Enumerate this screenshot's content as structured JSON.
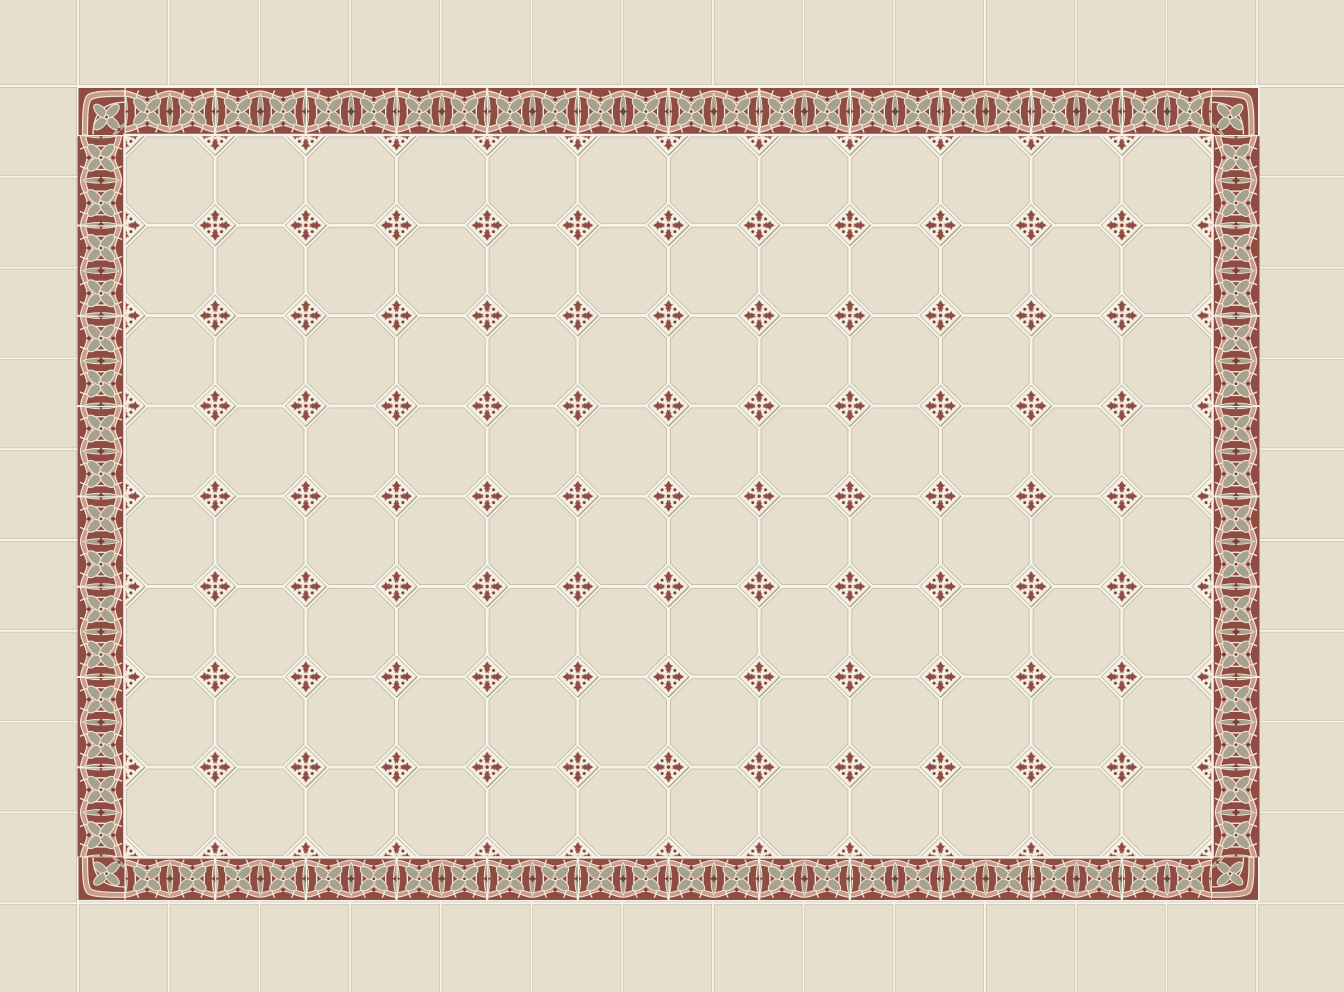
{
  "meta": {
    "label": "octagon-tile-floor-with-ornamental-border"
  },
  "palette": {
    "tile_cream": "#e6dfcd",
    "grout_white": "#f6f3e9",
    "grout_shadow": "#b9b2a0",
    "maroon": "#8e4c43",
    "maroon_deep": "#7c3d34",
    "grey_green": "#a7a190",
    "dusty_pink": "#c79e8d",
    "ribbon_cream": "#f1e5d2",
    "diamond_white": "#f3efe2",
    "diamond_shadow": "#a99f8b"
  },
  "layout": {
    "octagon_columns": 12,
    "octagon_rows": 8,
    "full_diamond_insert_columns": 11,
    "full_diamond_insert_rows": 7,
    "edge_half_diamonds_top": 11,
    "edge_half_diamonds_bottom": 11,
    "edge_half_diamonds_left": 7,
    "edge_half_diamonds_right": 7,
    "border_tiles_top": 12,
    "border_tiles_bottom": 12,
    "border_tiles_left": 8,
    "border_tiles_right": 8,
    "corner_tiles": 4
  },
  "motifs": {
    "border_tile": "two four-petal grey-green flowers in scalloped cream ribbon windows on maroon ground with leaf spindles at joints",
    "corner_tile": "single four-petal flower with L-shaped scalloped ribbon",
    "field_tile": "plain cream octagon",
    "insert_tile": "white diamond with maroon fleur cross and dotted centre",
    "outer_field": "plain cream square tiles"
  }
}
